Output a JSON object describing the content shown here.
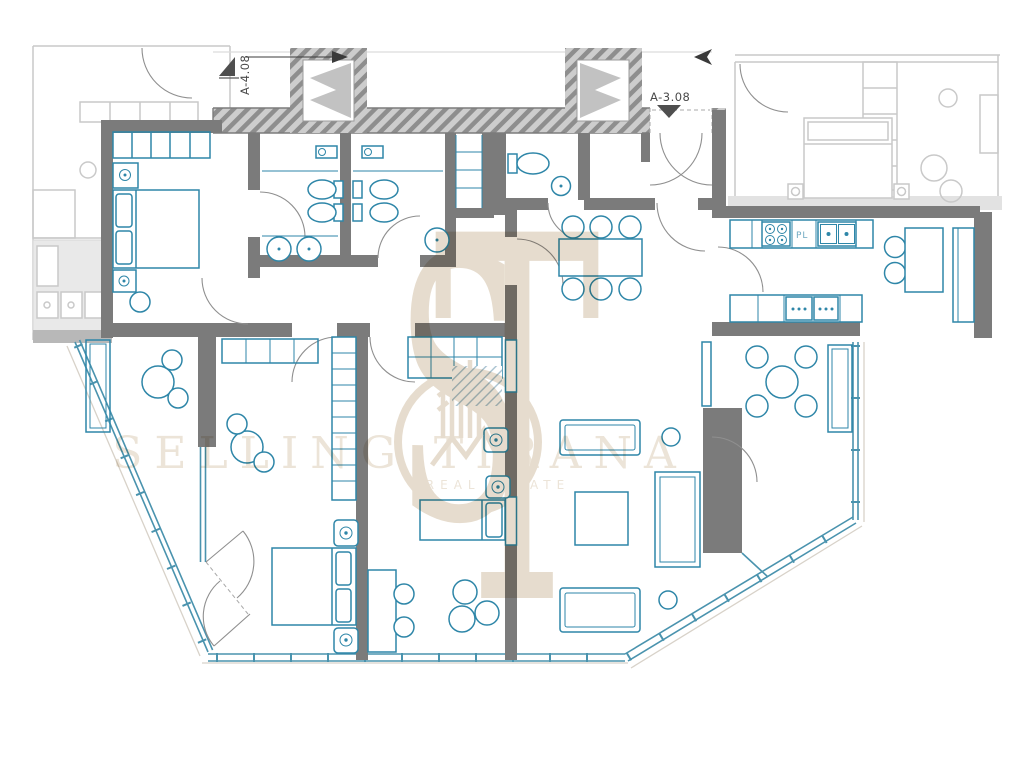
{
  "document": {
    "kind": "apartment-floor-plan"
  },
  "markers": {
    "section_marker_left": "A-4.08",
    "section_marker_top": "A-3.08"
  },
  "kitchen": {
    "hob_label": "PL"
  },
  "watermark": {
    "monogram_s": "S",
    "monogram_t": "T",
    "wordmark": "SELLING TIRANA",
    "tagline": "REAL ESTATE"
  },
  "colors": {
    "wall": "#7b7b7b",
    "teal": "#2e86a8",
    "glass": "#4a93ae",
    "faded": "#c9c9c9",
    "hatch": "#8e8e8e",
    "beige": "#d7c7af",
    "label": "#4a4a4a"
  }
}
